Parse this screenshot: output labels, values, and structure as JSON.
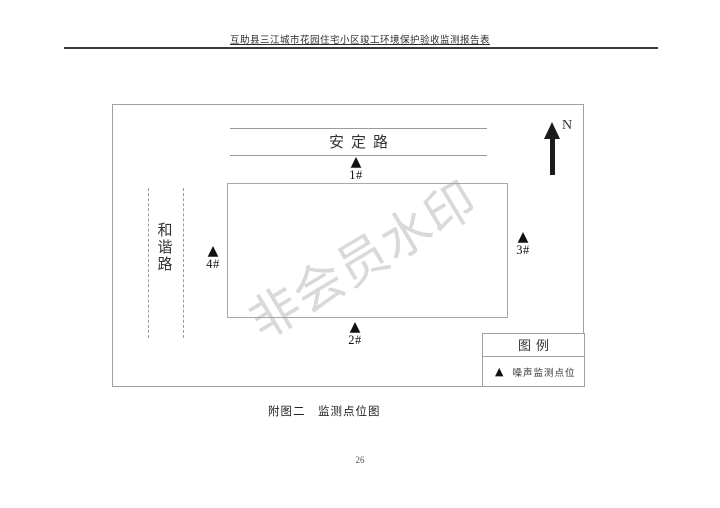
{
  "page": {
    "header_title": "互助县三江城市花园住宅小区竣工环境保护验收监测报告表",
    "caption": "附图二　监测点位图",
    "page_number": "26"
  },
  "diagram": {
    "top_road_label": "安定路",
    "left_road_chars": [
      "和",
      "谐",
      "路"
    ],
    "north_label": "N",
    "watermark_text": "非会员水印",
    "marker_symbol": "▲",
    "monitoring_points": [
      {
        "id": "point-1",
        "label": "1#"
      },
      {
        "id": "point-2",
        "label": "2#"
      },
      {
        "id": "point-3",
        "label": "3#"
      },
      {
        "id": "point-4",
        "label": "4#"
      }
    ],
    "legend": {
      "title": "图例",
      "items": [
        {
          "symbol": "▲",
          "label": "噪声监测点位"
        }
      ]
    },
    "colors": {
      "line_gray": "#a0a0a0",
      "marker_black": "#1b1b1b",
      "watermark_gray": "#d9d9d9"
    }
  }
}
